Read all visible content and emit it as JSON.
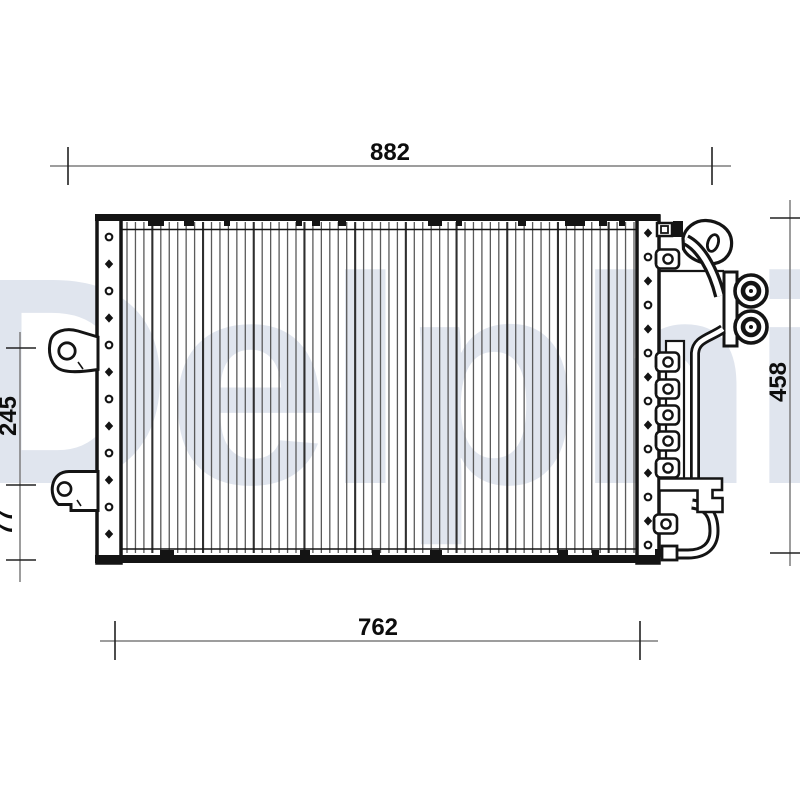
{
  "watermark": {
    "text": "Delphi",
    "color": "#e0e5ee"
  },
  "dimensions": {
    "top_width": "882",
    "bottom_width": "762",
    "right_height": "458",
    "left_upper_height": "245",
    "left_lower_height": "77"
  },
  "colors": {
    "outline": "#141414",
    "dimension_line": "#7d7d7d",
    "tick": "#222222",
    "fin_line": "#5a5a5a",
    "fin_line_dark": "#2f2f2f",
    "watermark_fill": "#e0e5ee"
  }
}
